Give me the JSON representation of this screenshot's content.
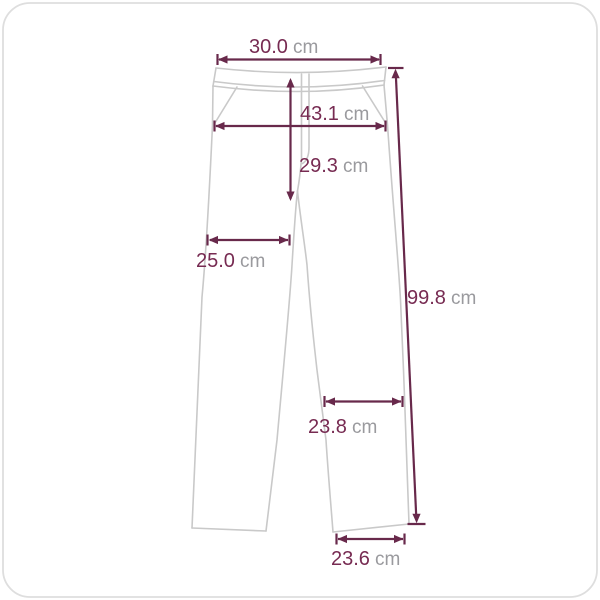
{
  "theme": {
    "background": "#ffffff",
    "border_color": "#dedede",
    "outline_color": "#c9c9c9",
    "dimension_color": "#68294b",
    "value_color": "#772b52",
    "unit_color": "#9a9a9e"
  },
  "diagram": {
    "garment": "pants",
    "measurements": {
      "waist": {
        "value": "30.0",
        "unit": "cm"
      },
      "hip": {
        "value": "43.1",
        "unit": "cm"
      },
      "rise": {
        "value": "29.3",
        "unit": "cm"
      },
      "thigh": {
        "value": "25.0",
        "unit": "cm"
      },
      "length": {
        "value": "99.8",
        "unit": "cm"
      },
      "knee": {
        "value": "23.8",
        "unit": "cm"
      },
      "hem": {
        "value": "23.6",
        "unit": "cm"
      }
    }
  }
}
